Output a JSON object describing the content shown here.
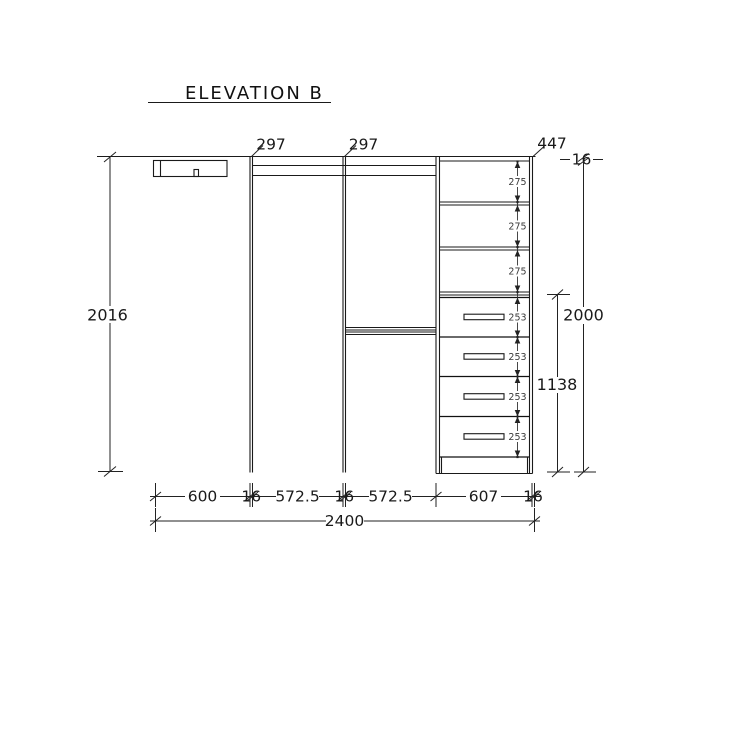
{
  "title": "ELEVATION B",
  "dims": {
    "top": {
      "gap1": "297",
      "gap2": "297",
      "unit": "447",
      "thickness": "16"
    },
    "left": {
      "height": "2016"
    },
    "right": {
      "total": "2000",
      "stack": "1138"
    },
    "shelves": [
      "275",
      "275",
      "275"
    ],
    "drawers": [
      "253",
      "253",
      "253",
      "253"
    ],
    "bottom": [
      "600",
      "16",
      "572.5",
      "16",
      "572.5",
      "607",
      "16"
    ],
    "overall": "2400"
  }
}
